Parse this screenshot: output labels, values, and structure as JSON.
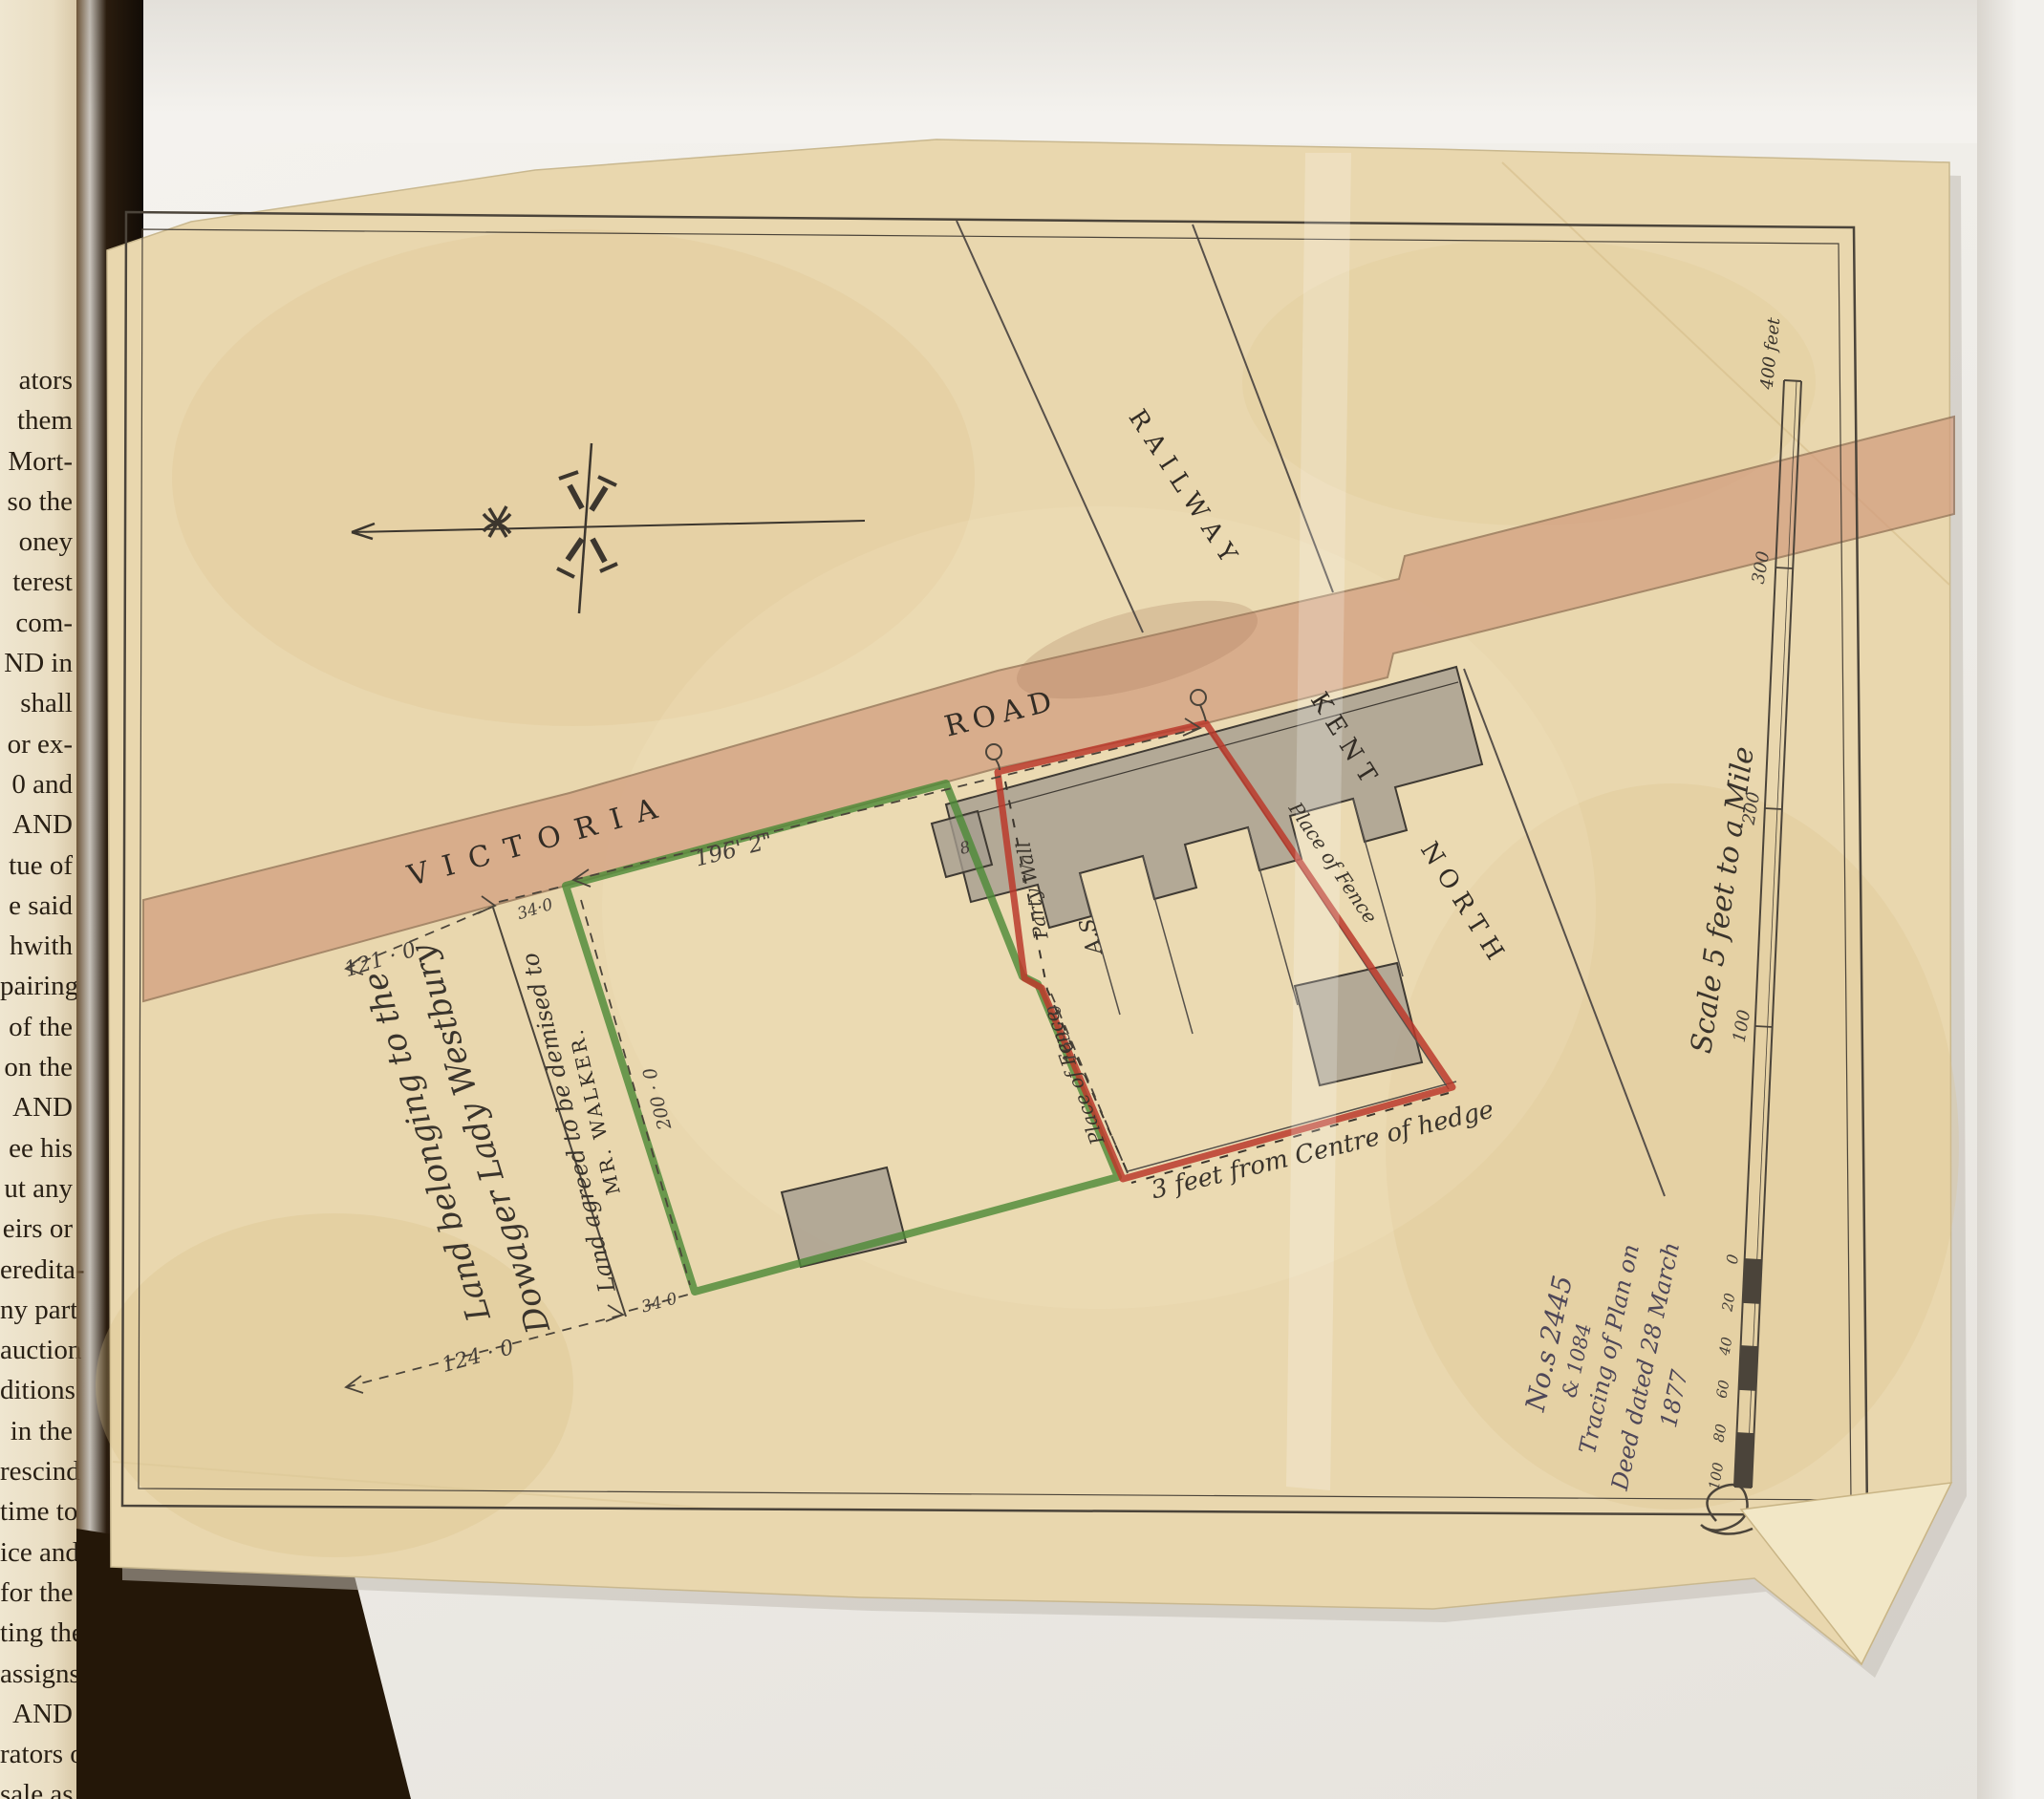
{
  "book_page": {
    "lines": [
      "ators",
      "them",
      "Mort-",
      "so the",
      "oney",
      "terest",
      "com-",
      "ND in",
      "shall",
      "or ex-",
      "0 and",
      "AND",
      "tue of",
      "e said",
      "hwith",
      "pairing",
      "of the",
      "on the",
      "AND",
      "ee his",
      "ut any",
      "eirs or",
      "eredita-",
      "ny part",
      "auction",
      "ditions",
      "in the",
      "rescind",
      "time to",
      "ice and",
      "for the",
      "ting the",
      "assigns",
      "AND",
      "rators or",
      "sale as"
    ]
  },
  "plan": {
    "road": {
      "name_part1": "VICTORIA",
      "name_part2": "ROAD"
    },
    "railway": {
      "label": "RAILWAY",
      "region_part1": "KENT",
      "region_part2": "NORTH"
    },
    "parcels": {
      "westbury_line1": "Land belonging to the",
      "westbury_line2": "Dowager Lady Westbury",
      "walker_line1": "Land agreed to be demised to",
      "walker_line2": "MR. WALKER."
    },
    "annotations": {
      "party_wall": "Party Wall",
      "place_of_fence_west": "Place of Fence",
      "place_of_fence_east": "Place of Fence",
      "hedge_note": "3 feet from Centre of hedge",
      "building_number": "8",
      "surveyor_initials": "A.S"
    },
    "dimensions": {
      "north_frontage": "121 · 0",
      "north_offset": "34·0",
      "road_frontage": "196' 2\"",
      "west_side": "200 · 0",
      "south_side": "124 · 0",
      "south_offset": "34·0",
      "party_wall_line": "169 · 0"
    },
    "scale_bar": {
      "caption": "Scale 5 feet to a Mile",
      "top_label": "400 feet",
      "tick_300": "300",
      "tick_200": "200",
      "tick_100": "100",
      "tick_0": "0",
      "sub_20": "20",
      "sub_40": "40",
      "sub_60": "60",
      "sub_80": "80",
      "sub_100": "100"
    },
    "inscription": {
      "line1": "No.s 2445",
      "line2": "& 1084",
      "line3": "Tracing of Plan on",
      "line4": "Deed dated 28 March",
      "line5": "1877"
    },
    "colors": {
      "road_pink": "#d29d7e",
      "boundary_green": "#4e8a38",
      "boundary_red": "#bb3a2b",
      "ink": "#4b443a",
      "sheet": "#e9d7ae"
    }
  }
}
